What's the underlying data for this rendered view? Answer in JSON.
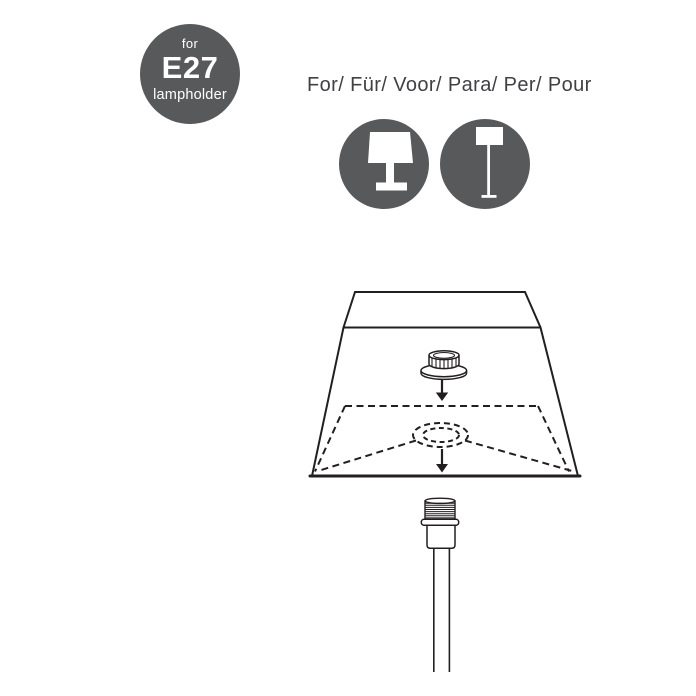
{
  "badge": {
    "top": "for",
    "code": "E27",
    "bottom": "lampholder",
    "bg_color": "#58595b",
    "text_color": "#ffffff"
  },
  "heading": {
    "text": "For/ Für/ Voor/ Para/ Per/ Pour",
    "color": "#404144"
  },
  "compatibility": {
    "icons": [
      {
        "name": "table-lamp-icon",
        "circle_color": "#58595b",
        "glyph_color": "#ffffff"
      },
      {
        "name": "floor-lamp-icon",
        "circle_color": "#58595b",
        "glyph_color": "#ffffff"
      }
    ]
  },
  "diagram": {
    "line_color": "#231f20",
    "background": "#ffffff"
  }
}
